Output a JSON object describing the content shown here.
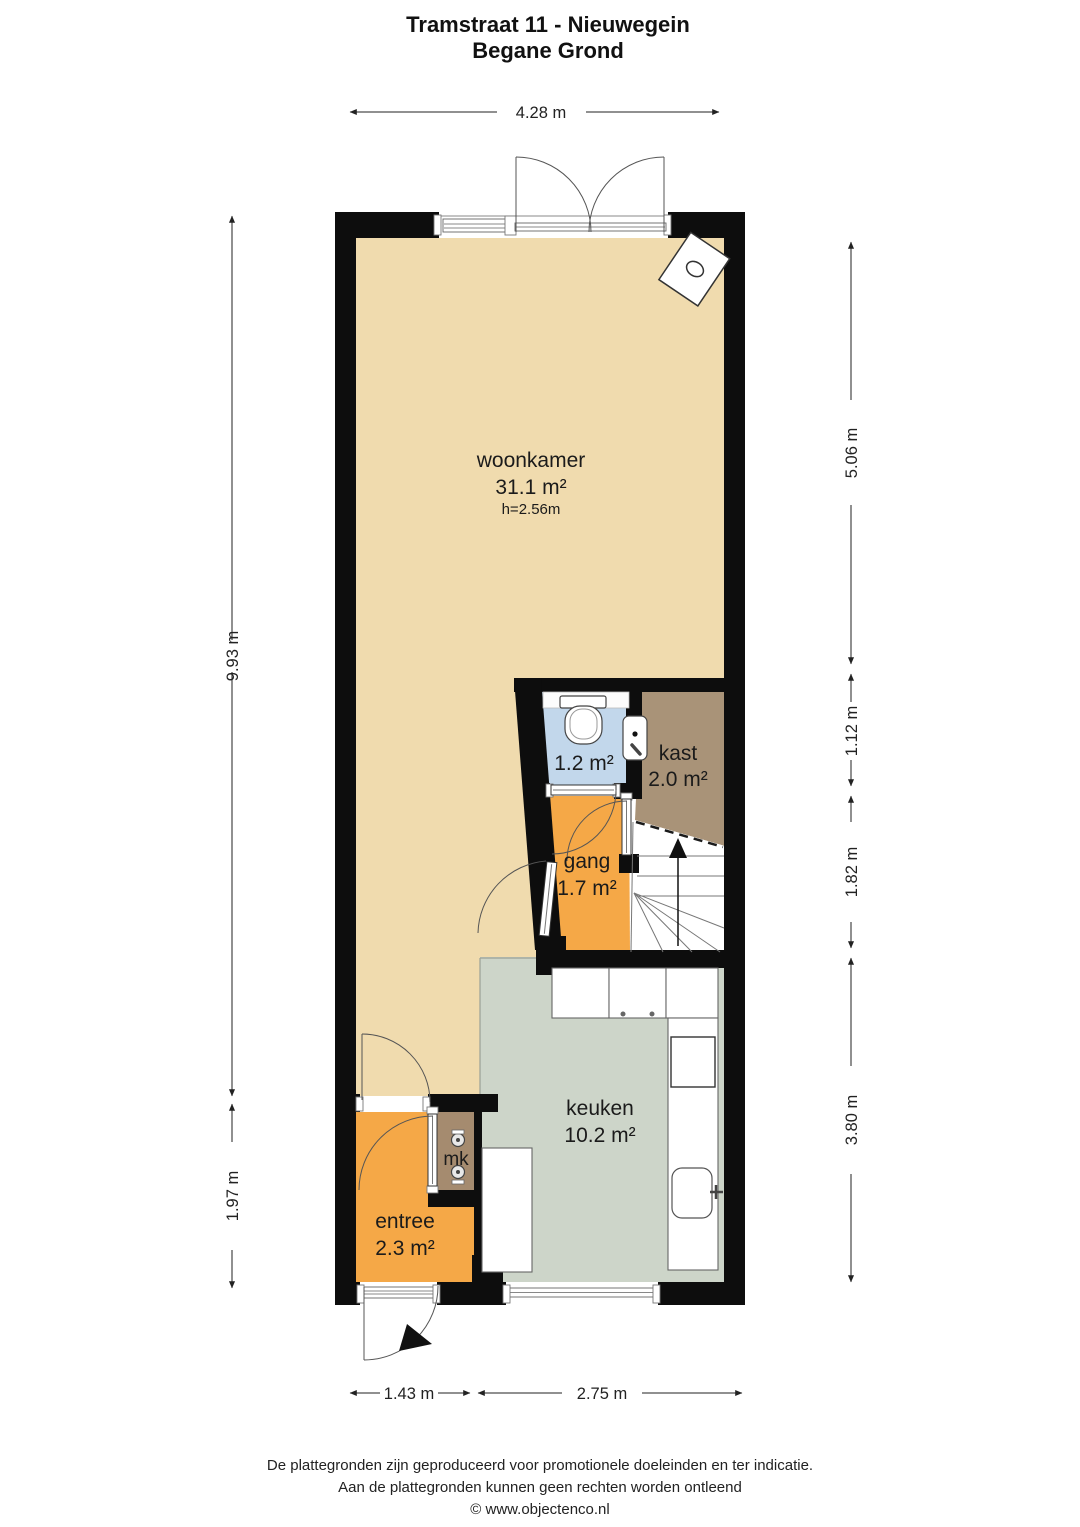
{
  "title": {
    "line1": "Tramstraat 11 - Nieuwegein",
    "line2": "Begane Grond"
  },
  "rooms": {
    "woonkamer": {
      "name": "woonkamer",
      "area": "31.1 m²",
      "ceiling_height": "h=2.56m",
      "color": "#f0dbae"
    },
    "toilet": {
      "area": "1.2 m²",
      "color": "#c2d7eb"
    },
    "kast": {
      "name": "kast",
      "area": "2.0 m²",
      "color": "#a99378"
    },
    "gang": {
      "name": "gang",
      "area": "1.7 m²",
      "color": "#f5a847"
    },
    "keuken": {
      "name": "keuken",
      "area": "10.2 m²",
      "color": "#cdd5c9"
    },
    "entree": {
      "name": "entree",
      "area": "2.3 m²",
      "color": "#f5a847"
    },
    "meterkast": {
      "name": "mk",
      "color": "#a58b6f"
    }
  },
  "dimensions": {
    "top_width": "4.28 m",
    "left_upper": "9.93 m",
    "left_lower": "1.97 m",
    "right_1": "5.06 m",
    "right_2": "1.12 m",
    "right_3": "1.82 m",
    "right_4": "3.80 m",
    "bottom_left": "1.43 m",
    "bottom_right": "2.75 m"
  },
  "footer": {
    "line1": "De plattegronden zijn geproduceerd voor promotionele doeleinden en ter indicatie.",
    "line2": "Aan de plattegronden kunnen geen rechten worden ontleend",
    "line3": "© www.objectenco.nl"
  },
  "colors": {
    "wall": "#0d0d0d",
    "dimension_line": "#222222",
    "fixture_stroke": "#444444",
    "page_bg": "#ffffff"
  },
  "fixtures": [
    "toilet",
    "fountain-sink",
    "boiler",
    "kitchen-counter",
    "cooktop",
    "kitchen-sink",
    "electric-meters",
    "staircase-up-arrow",
    "entry-door-arrow"
  ]
}
